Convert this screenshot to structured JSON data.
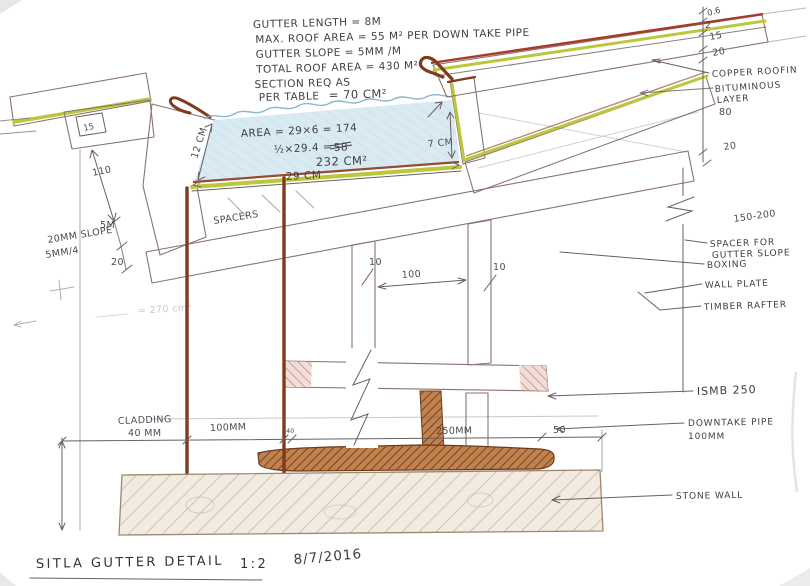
{
  "title": {
    "name": "SITLA GUTTER DETAIL",
    "scale": "1:2",
    "date": "8/7/2016"
  },
  "notes": {
    "l1": "GUTTER LENGTH = 8M",
    "l2": "MAX. ROOF AREA = 55 M² PER DOWN TAKE PIPE",
    "l3": "GUTTER SLOPE = 5MM /M",
    "l4": "TOTAL ROOF AREA = 430 M²",
    "l5": "SECTION REQ AS",
    "l6": "PER TABLE",
    "l7": "= 70 CM²"
  },
  "calc": {
    "a1": "AREA = 29×6 = 174",
    "a2": "½×29.4 =",
    "a2s": "58",
    "a3": "232 CM²",
    "faint": "= 270 cm²"
  },
  "gutter": {
    "width": "29 CM",
    "depth_left": "12 CM",
    "depth_right": "7 CM",
    "spacers": "SPACERS"
  },
  "left": {
    "box": "15",
    "h110": "110",
    "m5": "5M",
    "slope1": "20MM SLOPE",
    "slope2": "5MM/4",
    "t20": "20"
  },
  "mid": {
    "p1": "10",
    "span": "100",
    "p2": "10"
  },
  "bottom": {
    "clad1": "CLADDING",
    "clad2": "40 MM",
    "d100": "100MM",
    "d40": "40",
    "d250": "250MM",
    "d50": "50"
  },
  "rcol": {
    "d06": "0.6",
    "d2": "2",
    "d15": "15",
    "d20": "20",
    "d20b": "20",
    "d80": "80",
    "d150": "150-200"
  },
  "rlabels": {
    "copper": "COPPER ROOFIN",
    "bit1": "BITUMINOUS",
    "bit2": "LAYER",
    "sp1": "SPACER FOR",
    "sp2": "GUTTER SLOPE",
    "boxing": "BOXING",
    "wall": "WALL PLATE",
    "rafter": "TIMBER RAFTER",
    "beam": "ISMB 250",
    "pipe1": "DOWNTAKE PIPE",
    "pipe2": "100MM",
    "stone": "STONE WALL"
  },
  "colors": {
    "pencil": "#6a5f63",
    "handwriting": "#3e3e47",
    "pink_hatch": "#c4887d",
    "copper": "#7e3b1e",
    "lining_green": "#bcc83b",
    "roof_red": "#a63b2c",
    "water_blue": "#d9eaf2",
    "wood_brown": "#7c3f17",
    "stone_hatch": "#cdb296"
  }
}
